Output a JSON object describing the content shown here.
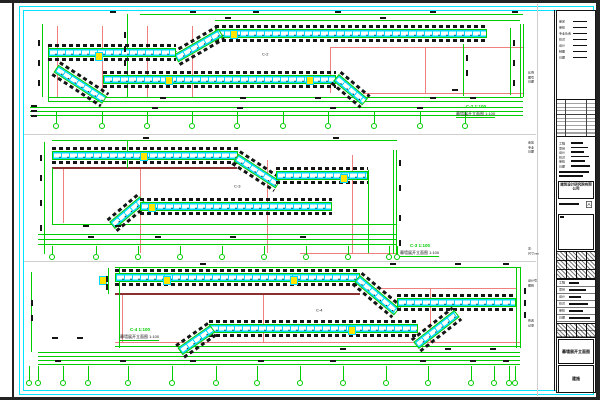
{
  "sheet": {
    "type": "cad-curtain-wall-elevation-sheet",
    "paper_border_color": "#232323",
    "frame_color": "#00e5ff",
    "background": "#ffffff"
  },
  "colors": {
    "green": "#00cc00",
    "red": "#f08080",
    "darkred": "#8b3030",
    "cyan": "#00d9ff",
    "yellow": "#ffe600",
    "black": "#151515",
    "gray": "#cfcfcf"
  },
  "drawing": {
    "strips": [
      {
        "id": "elevation-C2",
        "label": {
          "text": "C-2",
          "x": 262,
          "y": 52
        },
        "caption": {
          "x": 456,
          "y": 104,
          "tag": "C-2",
          "scale": "1:100",
          "title": "幕墙展开立面图",
          "suffix": "1:100"
        },
        "green_h": [
          [
            140,
            14,
            383
          ],
          [
            215,
            20,
            305
          ],
          [
            48,
            97,
            475
          ],
          [
            48,
            101,
            475
          ],
          [
            30,
            107,
            493
          ],
          [
            30,
            111,
            493
          ],
          [
            30,
            115,
            493
          ]
        ],
        "green_v": [
          [
            42,
            24,
            73
          ],
          [
            127,
            14,
            83
          ],
          [
            48,
            44,
            57
          ],
          [
            463,
            44,
            52
          ],
          [
            510,
            28,
            67
          ],
          [
            520,
            24,
            73
          ],
          [
            523,
            24,
            73
          ]
        ],
        "red_h": [
          [
            330,
            47,
            193
          ],
          [
            363,
            93,
            160
          ]
        ],
        "red_v": [
          [
            57,
            26,
            71
          ],
          [
            102,
            26,
            71
          ],
          [
            147,
            26,
            71
          ],
          [
            192,
            26,
            71
          ],
          [
            330,
            47,
            46
          ],
          [
            425,
            47,
            46
          ]
        ],
        "darkred_h": [],
        "bands": [
          [
            215,
            29,
            272,
            0
          ],
          [
            176,
            54,
            52,
            -30
          ],
          [
            48,
            48,
            128,
            0
          ],
          [
            56,
            64,
            58,
            33
          ],
          [
            103,
            75,
            233,
            0
          ],
          [
            336,
            73,
            38,
            40
          ]
        ],
        "yellow": [
          [
            230,
            30
          ],
          [
            165,
            76
          ],
          [
            306,
            76
          ],
          [
            95,
            52
          ]
        ],
        "bubbles": {
          "y": 126,
          "xs": [
            56,
            102,
            147,
            192,
            237,
            283,
            328,
            374,
            420,
            465
          ],
          "stub_y": 112
        },
        "marks": [
          [
            110,
            11
          ],
          [
            190,
            11
          ],
          [
            253,
            11
          ],
          [
            335,
            11
          ],
          [
            430,
            11
          ],
          [
            512,
            11
          ],
          [
            225,
            17
          ],
          [
            380,
            17
          ],
          [
            160,
            97
          ],
          [
            240,
            97
          ],
          [
            315,
            97
          ],
          [
            430,
            97
          ],
          [
            470,
            97
          ],
          [
            152,
            107
          ],
          [
            237,
            107
          ],
          [
            330,
            107
          ],
          [
            417,
            107
          ],
          [
            31,
            105
          ],
          [
            31,
            110
          ],
          [
            31,
            115
          ],
          [
            452,
            89
          ]
        ],
        "vmarks": [
          [
            38,
            40
          ],
          [
            38,
            60
          ],
          [
            38,
            80
          ],
          [
            124,
            32
          ],
          [
            124,
            46
          ],
          [
            124,
            60
          ],
          [
            513,
            40
          ],
          [
            513,
            60
          ],
          [
            513,
            80
          ],
          [
            466,
            55
          ],
          [
            466,
            70
          ]
        ]
      },
      {
        "id": "elevation-C3",
        "label": {
          "text": "C-3",
          "x": 234,
          "y": 184
        },
        "caption": {
          "x": 400,
          "y": 243,
          "tag": "C-3",
          "scale": "1:100",
          "title": "幕墙展开立面图",
          "suffix": "1:100"
        },
        "green_h": [
          [
            52,
            140,
            345
          ],
          [
            52,
            224,
            344
          ],
          [
            38,
            234,
            358
          ],
          [
            38,
            239,
            358
          ],
          [
            38,
            244,
            358
          ]
        ],
        "green_v": [
          [
            44,
            142,
            112
          ],
          [
            52,
            168,
            56
          ],
          [
            368,
            170,
            83
          ],
          [
            393,
            150,
            104
          ],
          [
            396,
            150,
            104
          ],
          [
            127,
            140,
            28
          ]
        ],
        "red_h": [
          [
            300,
            253,
            96
          ]
        ],
        "red_v": [
          [
            63,
            168,
            55
          ],
          [
            140,
            168,
            85
          ],
          [
            267,
            160,
            93
          ],
          [
            352,
            155,
            98
          ]
        ],
        "darkred_h": [
          [
            52,
            167,
            185
          ]
        ],
        "bands": [
          [
            52,
            151,
            186,
            0
          ],
          [
            236,
            153,
            50,
            33
          ],
          [
            276,
            171,
            92,
            0
          ],
          [
            112,
            221,
            40,
            -40
          ],
          [
            140,
            202,
            192,
            0
          ]
        ],
        "yellow": [
          [
            140,
            152
          ],
          [
            148,
            203
          ],
          [
            340,
            174
          ]
        ],
        "bubbles": {
          "y": 257,
          "xs": [
            52,
            96,
            138,
            180,
            222,
            264,
            306,
            348,
            389,
            397
          ],
          "stub_y": 246
        },
        "marks": [
          [
            143,
            137
          ],
          [
            333,
            137
          ],
          [
            83,
            225
          ],
          [
            115,
            225
          ],
          [
            88,
            236
          ],
          [
            155,
            236
          ],
          [
            230,
            236
          ],
          [
            300,
            236
          ]
        ],
        "vmarks": [
          [
            40,
            155
          ],
          [
            40,
            175
          ],
          [
            40,
            200
          ],
          [
            40,
            225
          ],
          [
            399,
            160
          ],
          [
            399,
            185
          ],
          [
            399,
            215
          ],
          [
            399,
            240
          ]
        ]
      },
      {
        "id": "elevation-C4",
        "label": {
          "text": "C-4",
          "x": 316,
          "y": 308
        },
        "caption": {
          "x": 120,
          "y": 327,
          "tag": "C-4",
          "scale": "1:100",
          "title": "幕墙展开立面图",
          "suffix": "1:100"
        },
        "green_h": [
          [
            115,
            267,
            405
          ],
          [
            115,
            346,
            405
          ],
          [
            38,
            352,
            482
          ],
          [
            38,
            356,
            482
          ],
          [
            38,
            360,
            482
          ],
          [
            38,
            364,
            482
          ]
        ],
        "green_v": [
          [
            31,
            272,
            80
          ],
          [
            108,
            268,
            26
          ],
          [
            119,
            268,
            80
          ],
          [
            516,
            267,
            81
          ],
          [
            520,
            267,
            81
          ]
        ],
        "red_h": [
          [
            360,
            288,
            157
          ],
          [
            115,
            342,
            405
          ]
        ],
        "red_v": [
          [
            122,
            294,
            48
          ],
          [
            263,
            294,
            48
          ],
          [
            430,
            288,
            54
          ]
        ],
        "darkred_h": [
          [
            115,
            293,
            245
          ]
        ],
        "bands": [
          [
            115,
            273,
            245,
            0
          ],
          [
            357,
            274,
            52,
            40
          ],
          [
            397,
            298,
            119,
            0
          ],
          [
            416,
            341,
            52,
            -38
          ],
          [
            209,
            324,
            209,
            0
          ],
          [
            180,
            347,
            40,
            -35
          ]
        ],
        "yellow": [
          [
            99,
            276
          ],
          [
            163,
            276
          ],
          [
            290,
            276
          ],
          [
            348,
            326
          ]
        ],
        "bubbles": {
          "y": 383,
          "xs": [
            29,
            38,
            63,
            88,
            128,
            172,
            216,
            257,
            300,
            343,
            386,
            428,
            471,
            494,
            509,
            515
          ],
          "stub_y": 366
        },
        "marks": [
          [
            200,
            263
          ],
          [
            390,
            263
          ],
          [
            455,
            263
          ],
          [
            503,
            263
          ],
          [
            52,
            337
          ],
          [
            77,
            337
          ],
          [
            340,
            348
          ],
          [
            445,
            348
          ],
          [
            490,
            348
          ],
          [
            55,
            360
          ],
          [
            120,
            360
          ],
          [
            190,
            360
          ],
          [
            258,
            360
          ],
          [
            330,
            360
          ],
          [
            420,
            360
          ],
          [
            470,
            360
          ],
          [
            503,
            360
          ]
        ],
        "vmarks": [
          [
            31,
            300
          ],
          [
            31,
            315
          ],
          [
            106,
            276
          ],
          [
            106,
            284
          ],
          [
            524,
            288
          ],
          [
            524,
            300
          ],
          [
            524,
            312
          ]
        ]
      }
    ]
  },
  "title_block": {
    "top_rows": [
      "审定",
      "审核",
      "专业负责",
      "校对",
      "设计",
      "制图",
      "日期"
    ],
    "company": "建筑设计研究院有限公司",
    "revision_box_label": "A",
    "field_rows": [
      "工程",
      "项目",
      "设计",
      "校对",
      "审核",
      "日期"
    ],
    "stamp1": "幕墙展开立面图",
    "stamp2": "建施",
    "left_notes": [
      {
        "y": 70,
        "lines": [
          "比例",
          "图号",
          "日期"
        ]
      },
      {
        "y": 140,
        "lines": [
          "会签",
          "专业",
          "日期"
        ]
      },
      {
        "y": 246,
        "lines": [
          "注:",
          "尺寸mm"
        ]
      },
      {
        "y": 278,
        "lines": [
          "设计号",
          "图别"
        ]
      },
      {
        "y": 318,
        "lines": [
          "修改",
          "记录"
        ]
      }
    ]
  }
}
